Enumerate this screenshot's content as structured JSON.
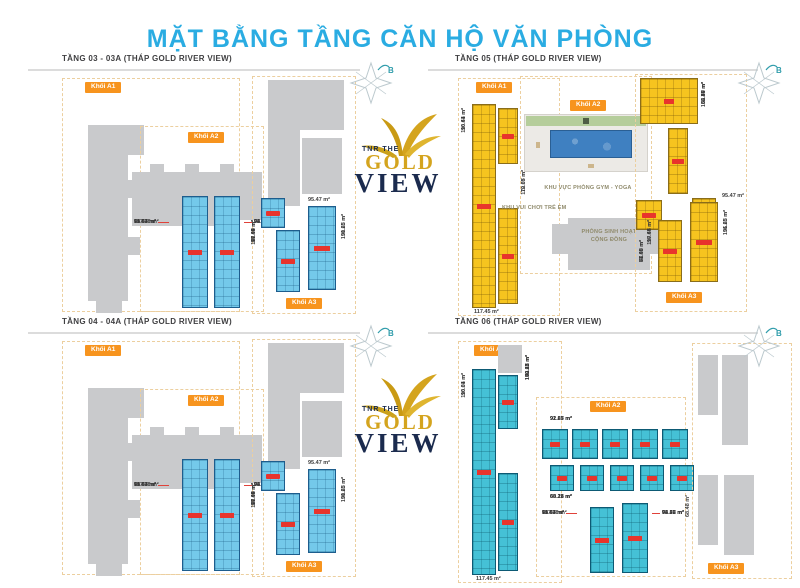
{
  "page": {
    "title": "MẶT BẰNG TẦNG CĂN HỘ VĂN PHÒNG"
  },
  "logo": {
    "top": "TNR THE",
    "gold": "GOLD",
    "view": "VIEW"
  },
  "compass": {
    "label": "B"
  },
  "floors": {
    "f03": {
      "title": "TẦNG 03 - 03A (THÁP GOLD RIVER VIEW)",
      "block_a1": "Khối A1",
      "block_a2": "Khối A2",
      "block_a3": "Khối A3",
      "twin_left": [
        "65.47 m²",
        "71.54 m²",
        "90.04 m²",
        "117.38 m²"
      ],
      "twin_right": [
        "63.47 m²",
        "72.73 m²",
        "96.22 m²",
        "94.06 m²"
      ],
      "a3_top": "95.47 m²",
      "a3_left": [
        "77.45 m²",
        "81.09 m²",
        "90.44 m²",
        "117.45 m²"
      ],
      "a3_right": [
        "90.23 m²",
        "131.65 m²"
      ]
    },
    "f04": {
      "title": "TẦNG 04 - 04A (THÁP GOLD RIVER VIEW)",
      "block_a1": "Khối A1",
      "block_a2": "Khối A2",
      "block_a3": "Khối A3",
      "twin_left": [
        "65.47 m²",
        "71.54 m²",
        "90.04 m²",
        "117.38 m²"
      ],
      "twin_right": [
        "63.47 m²",
        "72.73 m²",
        "96.22 m²",
        "94.06 m²"
      ],
      "a3_top": "95.47 m²",
      "a3_left": [
        "77.45 m²",
        "81.09 m²",
        "90.44 m²",
        "117.45 m²"
      ],
      "a3_right": [
        "90.23 m²",
        "131.65 m²"
      ]
    },
    "f05": {
      "title": "TẦNG 05 (THÁP GOLD RIVER VIEW)",
      "block_a1": "Khối A1",
      "block_a2": "Khối A2",
      "block_a3": "Khối A3",
      "a1_left": [
        "116.61 m²",
        "90.44 m²"
      ],
      "a1_bottom": "117.45 m²",
      "a1_right": [
        "112.07 m²",
        "70.65 m²"
      ],
      "gym": "KHU VỰC PHÒNG GYM - YOGA",
      "kids": "KHU VUI CHƠI TRẺ EM",
      "community": "PHÒNG SINH HOẠT CỘNG ĐỒNG",
      "mid": [
        "58.48 m²",
        "77.45 m²",
        "81.09 m²"
      ],
      "a3_side": [
        "132.86 m²",
        "58.47 m²",
        "63.70 m²",
        "86.49 m²"
      ],
      "a3_top": "95.47 m²",
      "a3_left": [
        "90.64 m²",
        "117.45 m²"
      ],
      "a3_right": [
        "96.23 m²",
        "131.65 m²"
      ]
    },
    "f06": {
      "title": "TẦNG 06 (THÁP GOLD RIVER VIEW)",
      "block_a1": "Khối A1",
      "block_a2": "Khối A2",
      "block_a3": "Khối A3",
      "a1_left": [
        "116.61 m²",
        "90.04 m²"
      ],
      "a1_bottom": "117.45 m²",
      "a1_right": [
        "152.27 m²",
        "83.11 m²",
        "100.12 m²",
        "70.65 m²"
      ],
      "row1": [
        "92.27 m²",
        "91.65 m²",
        "92.83 m²"
      ],
      "row2": [
        "69.11 m²",
        "88.28 m²",
        "68.28 m²"
      ],
      "twin_left": [
        "65.47 m²",
        "71.54 m²",
        "90.04 m²",
        "117.38 m²"
      ],
      "twin_right": [
        "63.47 m²",
        "72.73 m²",
        "96.22 m²",
        "94.06 m²"
      ],
      "side": "68.48 m²"
    }
  }
}
